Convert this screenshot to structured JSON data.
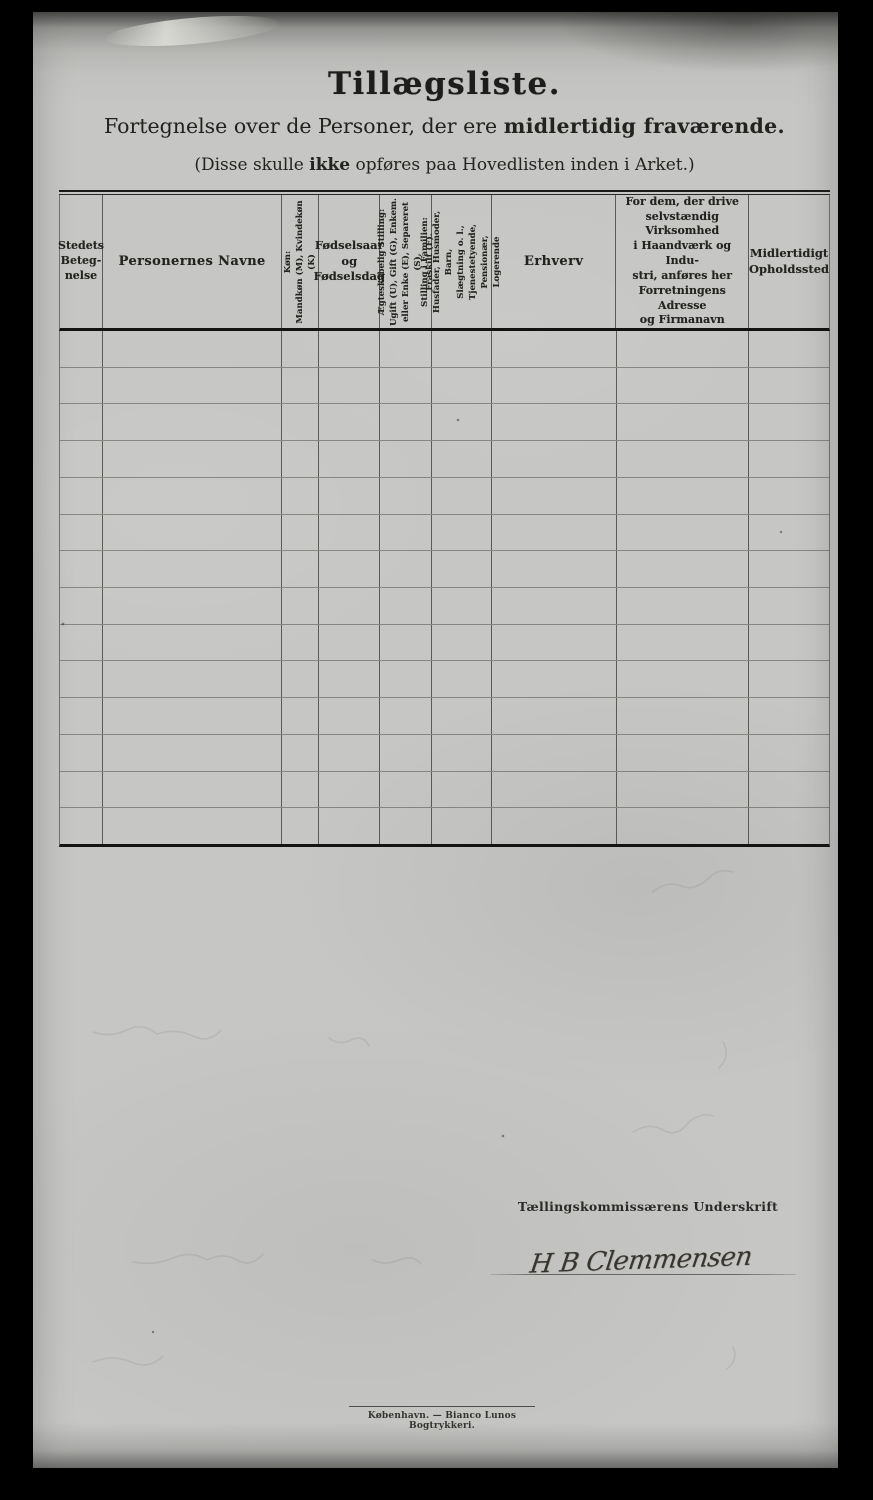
{
  "header": {
    "title": "Tillægsliste.",
    "subtitle_regular": "Fortegnelse over de Personer, der ere ",
    "subtitle_bold": "midlertidig fraværende.",
    "note_prefix": "(Disse skulle ",
    "note_bold": "ikke",
    "note_suffix": " opføres paa Hovedlisten inden i Arket.)"
  },
  "table": {
    "columns": [
      {
        "id": "stedets-betegnelse",
        "orientation": "horizontal",
        "label": "Stedets\nBeteg-\nnelse"
      },
      {
        "id": "personernes-navne",
        "orientation": "horizontal",
        "label": "Personernes Navne"
      },
      {
        "id": "koen",
        "orientation": "vertical",
        "label": "Køn:\nMandkøn (M), Kvindekøn (K)"
      },
      {
        "id": "foedselsaar-og-foedselsdag",
        "orientation": "horizontal",
        "label": "Fødselsaar\nog\nFødselsdag"
      },
      {
        "id": "aegteskabelig-stilling",
        "orientation": "vertical",
        "label": "Ægteskabelig Stilling:\nUgift (U), Gift (G), Enkem.\neller Enke (E), Separeret (S),\nFraskilt (F)."
      },
      {
        "id": "stilling-i-familien",
        "orientation": "vertical",
        "label": "Stilling i Familien:\nHusfader, Husmoder, Barn,\nSlægtning o. l.,\nTjenestetyende, Pensionær,\nLogerende"
      },
      {
        "id": "erhverv",
        "orientation": "horizontal",
        "label": "Erhverv"
      },
      {
        "id": "virksomheds-adresse",
        "orientation": "horizontal",
        "label": "For dem, der drive\nselvstændig Virksomhed\ni Haandværk og Indu-\nstri, anføres her\nForretningens Adresse\nog Firmanavn"
      },
      {
        "id": "midlertidigt-opholdssted",
        "orientation": "horizontal",
        "label": "Midlertidigt\nOpholdssted"
      }
    ],
    "empty_row_count": 14
  },
  "signature": {
    "label": "Tællingskommissærens Underskrift",
    "name": "H B Clemmensen"
  },
  "footer": {
    "imprint": "København. — Bianco Lunos Bogtrykkeri."
  },
  "colors": {
    "scan_background": "#000000",
    "paper": "#c6c6c4",
    "ink": "#232321"
  }
}
